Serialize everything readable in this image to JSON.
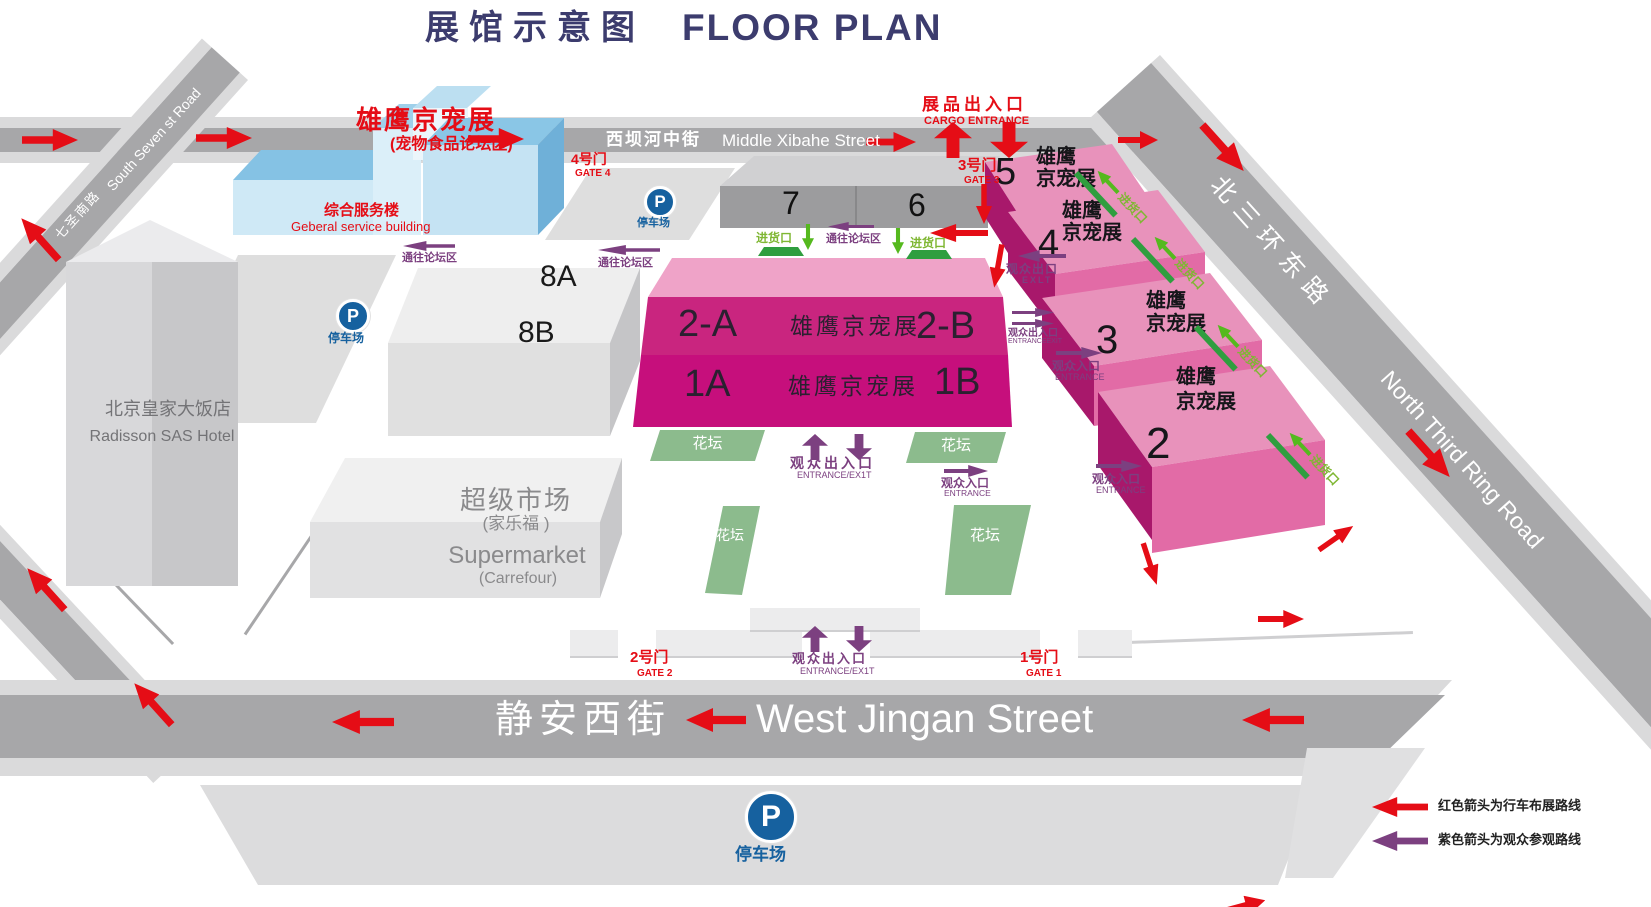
{
  "title": {
    "zh": "展馆示意图",
    "en": "FLOOR PLAN"
  },
  "streets": {
    "xibahe": {
      "zh": "西坝河中街",
      "en": "Middle Xibahe Street"
    },
    "jingan": {
      "zh": "静安西街",
      "en": "West Jingan Street"
    },
    "seven": {
      "zh": "七圣南路",
      "en": "South Seven st Road"
    },
    "ring": {
      "zh": "北三环东路",
      "en": "North Third Ring Road"
    }
  },
  "buildings": {
    "service": {
      "brand": "雄鹰京宠展",
      "brand_sub": "(宠物食品论坛区)",
      "zh": "综合服务楼",
      "en": "Geberal service building"
    },
    "hotel": {
      "zh": "北京皇家大饭店",
      "en": "Radisson SAS Hotel"
    },
    "market": {
      "zh": "超级市场",
      "zh_sub": "(家乐福 )",
      "en": "Supermarket",
      "en_sub": "(Carrefour)"
    }
  },
  "halls": {
    "h7": "7",
    "h6": "6",
    "h8a": "8A",
    "h8b": "8B",
    "center": {
      "a2": "2-A",
      "b2": "2-B",
      "a1": "1A",
      "b1": "1B",
      "brand": "雄鹰京宠展"
    },
    "right": [
      {
        "num": "5",
        "line1": "雄鹰",
        "line2": "京宠展"
      },
      {
        "num": "4",
        "line1": "雄鹰",
        "line2": "京宠展"
      },
      {
        "num": "3",
        "line1": "雄鹰",
        "line2": "京宠展"
      },
      {
        "num": "2",
        "line1": "雄鹰",
        "line2": "京宠展"
      }
    ]
  },
  "gates": {
    "g1": {
      "zh": "1号门",
      "en": "GATE 1"
    },
    "g2": {
      "zh": "2号门",
      "en": "GATE 2"
    },
    "g3": {
      "zh": "3号门",
      "en": "GATE 3"
    },
    "g4": {
      "zh": "4号门",
      "en": "GATE 4"
    }
  },
  "cargo": {
    "zh": "展品出入口",
    "en": "CARGO ENTRANCE"
  },
  "labels": {
    "parking": "停车场",
    "flowerbed": "花坛",
    "goods": "进货口",
    "forum": "通往论坛区",
    "vee": {
      "zh": "观众出入口",
      "en": "ENTRANCE/EX1T"
    },
    "vee_small": {
      "zh": "观众出入口",
      "en": "ENTRANCEEXIT"
    },
    "vexit": {
      "zh": "观众出口",
      "en": "EXLT"
    },
    "vent": {
      "zh": "观众入口",
      "en": "ENTRANCE"
    }
  },
  "legend": [
    {
      "color": "#e50d16",
      "text": "红色箭头为行车布展路线"
    },
    {
      "color": "#7c4080",
      "text": "紫色箭头为观众参观路线"
    }
  ],
  "colors": {
    "title": "#3c3c6e",
    "red": "#e50d16",
    "purple": "#7c4080",
    "green_arrow": "#55b91e",
    "green_dock": "#2f9e3f",
    "flowerbed": "#8cbb8d",
    "road_dark": "#a7a7a9",
    "road_light": "#dadadb",
    "hall_magenta": "#c9257f",
    "hall_deep": "#c60f7c",
    "hall_roof": "#efa3c8",
    "right_hall_top": "#e892bb",
    "right_hall_front": "#e26ba6",
    "right_hall_side": "#a8186b",
    "blue_top": "#85c2e4",
    "blue_front": "#cfe9f6",
    "parking_blue": "#16619f"
  }
}
